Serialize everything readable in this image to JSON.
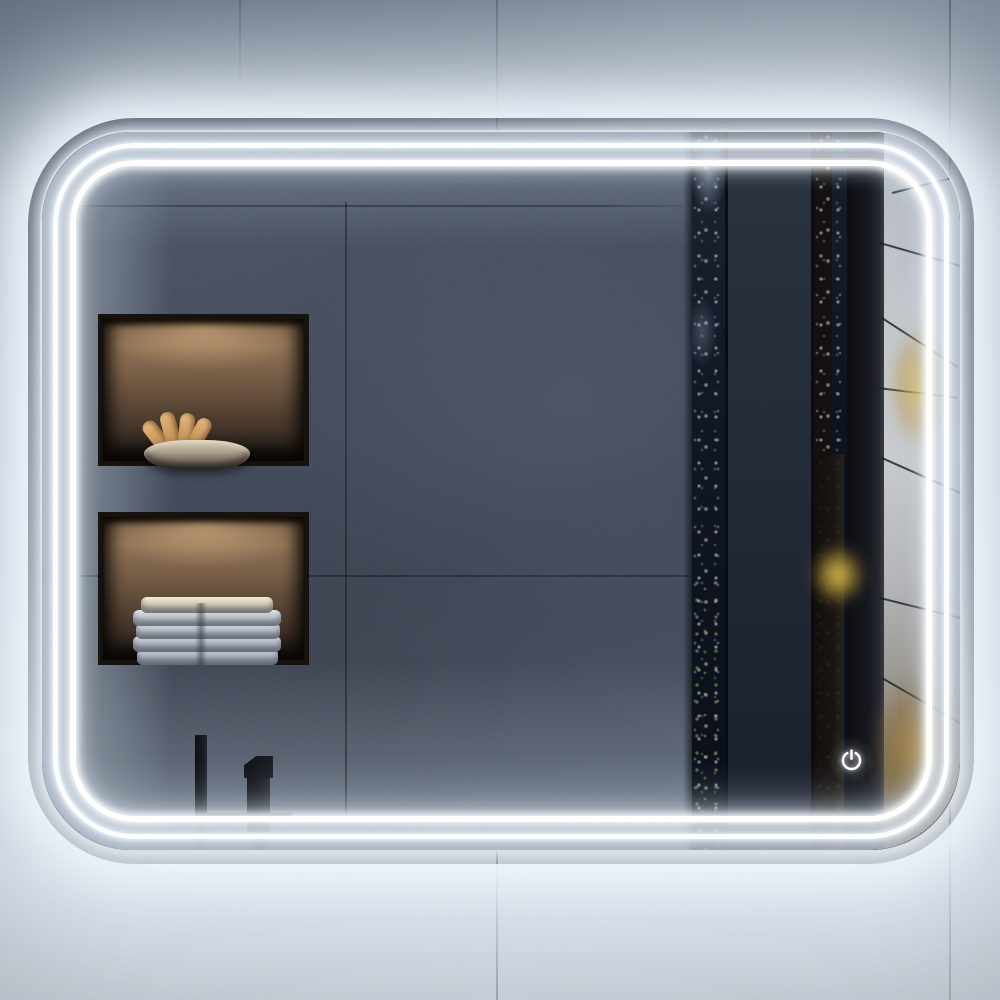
{
  "scene": {
    "description": "Backlit LED bathroom mirror with rounded corners and double light strips, mounted on a concrete tile wall",
    "labels": {
      "wall": "Concrete tile wall",
      "mirror": "LED illuminated mirror",
      "glow": "LED backlight glow on wall",
      "reflection_wall": "Reflected dark tiled bathroom wall",
      "niche_bowl": "Recessed wall shelf with stone bowl and rolled decor",
      "niche_towels": "Recessed wall shelf with stack of folded towels",
      "faucet": "Matte black faucet reflection",
      "forest": "Reflected forest view with fog and autumn foliage",
      "power_button": "Power touch control"
    },
    "mirror": {
      "shape": "rounded rectangle",
      "led_strip_count": 2,
      "led_color": "#ffffff",
      "glow_color": "#e8f1fa"
    },
    "touch_control": {
      "icon": "power-icon",
      "label": "Power",
      "color": "#ffffff"
    },
    "reflection": {
      "wall_color": "#3f4754",
      "niche_light": "warm",
      "bowl": {
        "material_color": "#b3a893",
        "decor_color": "#d2a468"
      },
      "towels": {
        "count": 5,
        "top_color": "#ece2cd",
        "body_color": "#c9ced4"
      },
      "faucet_color": "#101318",
      "forest": {
        "fog_color": "#c4c8cd",
        "trunk_color": "#15181e",
        "leaf_color": "#d3ae4c",
        "pillar_color": "#262c38"
      }
    },
    "wall": {
      "top_color": "#6f7988",
      "bottom_color": "#b2b8c1",
      "grout_color": "#2b3340"
    }
  }
}
